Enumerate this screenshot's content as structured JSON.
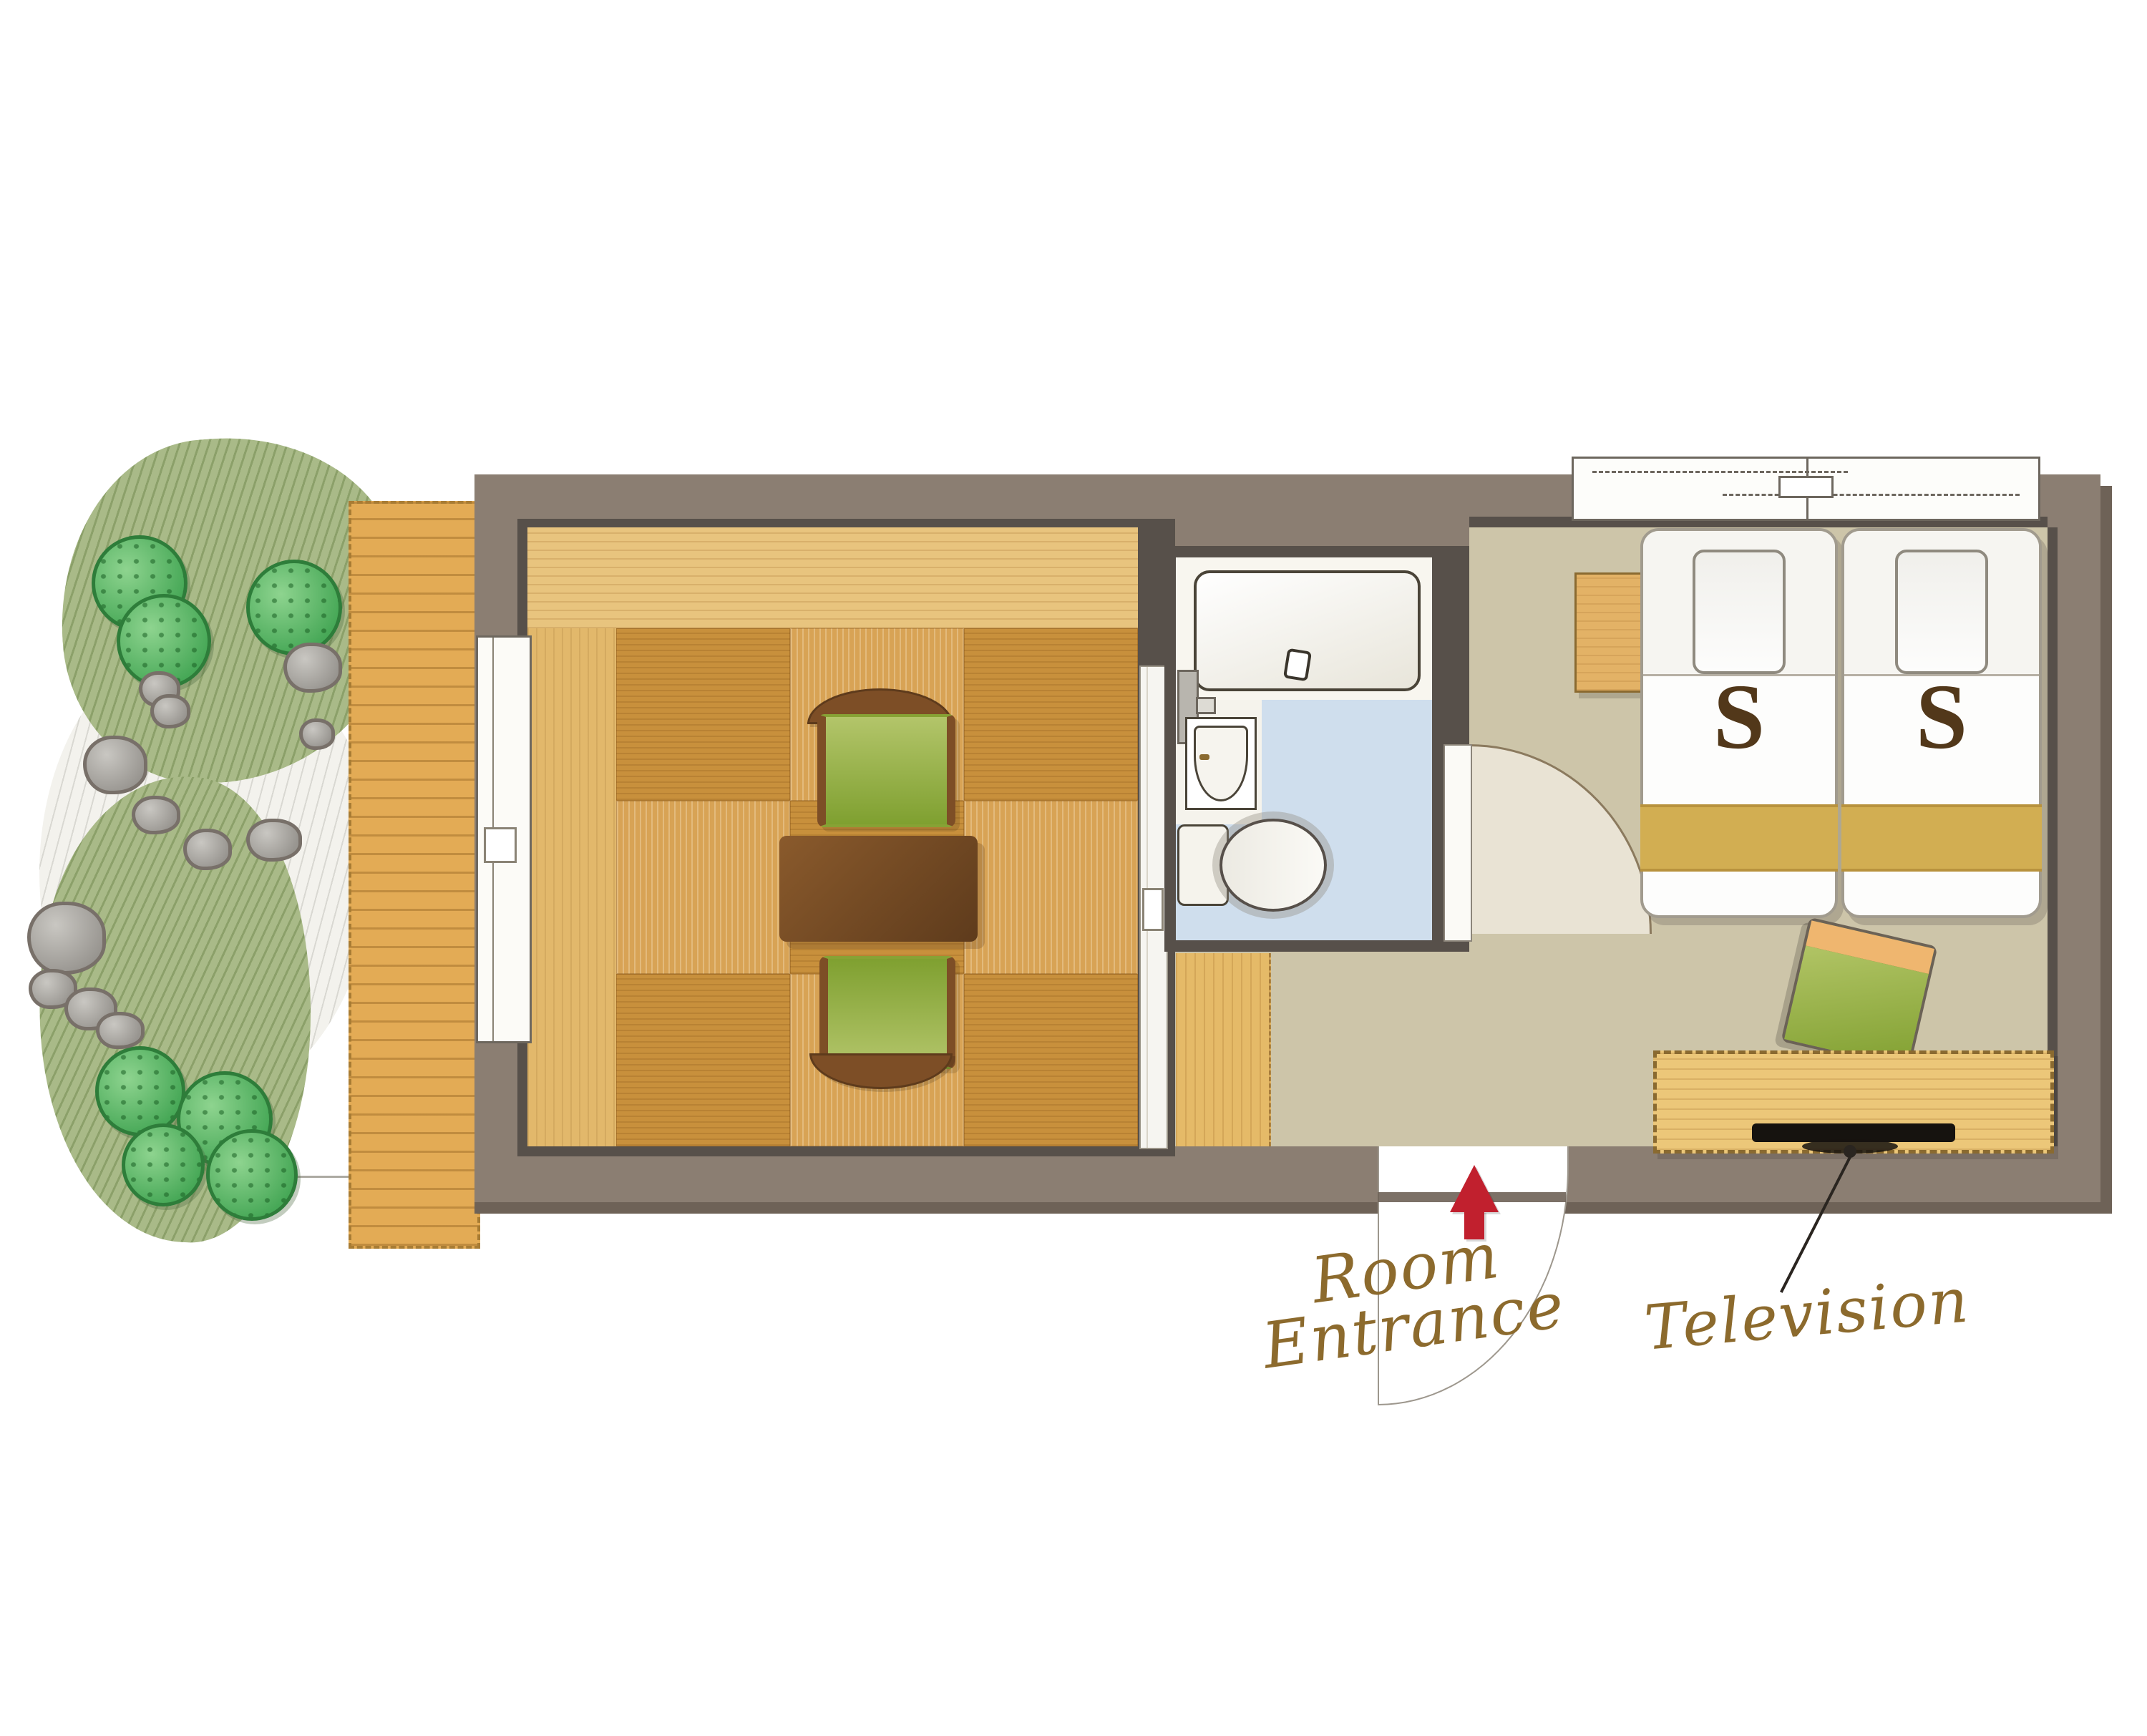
{
  "floorplan": {
    "labels": {
      "room_entrance_line1": "Room",
      "room_entrance_line2": "Entrance",
      "television": "Television"
    },
    "beds": [
      {
        "label": "S"
      },
      {
        "label": "S"
      }
    ],
    "icons": {
      "entrance_arrow": "red-up-arrow-icon"
    },
    "colors": {
      "outer_wall": "#8b7e72",
      "inner_wall": "#57504a",
      "tatami_light": "#d8a355",
      "tatami_dark": "#c8903c",
      "tokonoma_wood": "#e8c47e",
      "deck_wood": "#e3ab55",
      "bathroom_floor": "#cfdeed",
      "bedroom_floor": "#cdc5a9",
      "bed_gold_band": "#d2ae52",
      "entrance_arrow_red": "#c1202e",
      "label_brown": "#8c6a2d",
      "chair_green": "#9eb648",
      "bush_green": "#47a857"
    }
  }
}
